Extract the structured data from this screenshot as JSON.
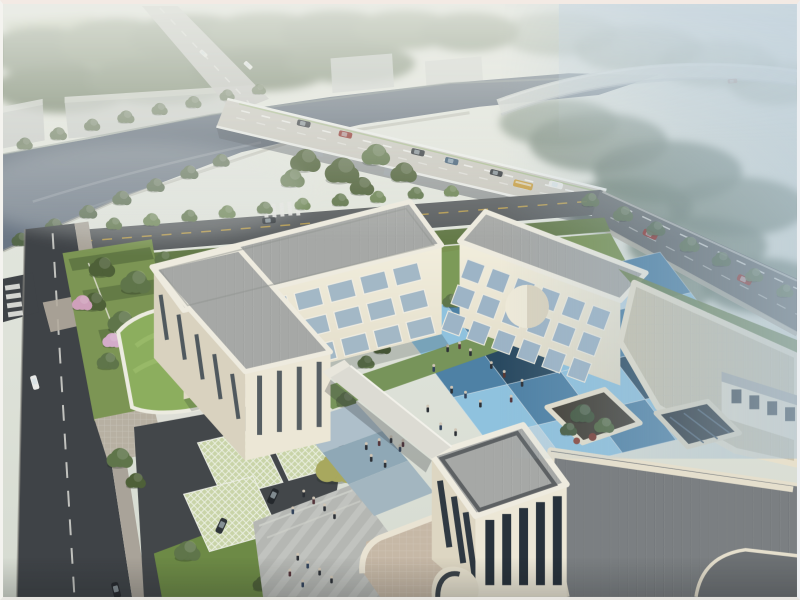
{
  "meta": {
    "title": "Aerial architectural rendering of a courtyard campus beside a river and highway bridge",
    "image_type": "architectural-render",
    "view": "bird's-eye perspective",
    "atmosphere": "hazy daylight, blue mist toward upper right",
    "canvas": {
      "width": 800,
      "height": 600
    }
  },
  "scene": {
    "background": {
      "haze_top": "#e9ebe3",
      "haze_blue": "#a9bfd0",
      "elements": [
        "misty tree canopy",
        "grey warehouse blocks",
        "distant road with small white vehicles",
        "elevated highway ramp curving across upper right"
      ]
    },
    "river": {
      "color": "#5d6a79",
      "description": "tree-lined canal crossing the upper left diagonally"
    },
    "bridge": {
      "deck_color": "#cbc9c0",
      "description": "multi-lane road bridge crossing the river diagonally",
      "vehicles": [
        "dark sedans",
        "dark red car",
        "blue car",
        "yellow bus",
        "white van"
      ],
      "markings": [
        "white dashed lanes",
        "green edge line",
        "white railings"
      ]
    },
    "roads": {
      "asphalt_dark": "#3f4347",
      "asphalt_mid": "#64686a",
      "features": [
        "left perimeter road with dashed centerline and zebra crosswalk",
        "frontage road with yellow dashes and crosswalk",
        "right road with two red cars",
        "entrance drive with boom barrier"
      ]
    },
    "campus": {
      "stories": 3,
      "wall_color": "#ece7d7",
      "roof_paver_light": "#a6a8a6",
      "roof_paver_tan": "#cbc4ad",
      "roof_paver_dark": "#7b7f82",
      "parapet_color": "#eeebdf",
      "wings": [
        "left L-shaped wing",
        "back wing along road",
        "cylindrical stair drum",
        "front wing with entrance drum and pink podium terrace",
        "large east wing with planted roof terrace and glass skylight"
      ],
      "courtyard": {
        "description": "checkerboard plaza of large square pavers in blues with pedestrians and blossom tree",
        "tile_colors": [
          "#8fc2de",
          "#4e81a5",
          "#2a4a61",
          "#b9d2df"
        ]
      },
      "gatehouse": {
        "green_roof": "#8cae5e",
        "description": "curved lawn-roofed entrance canopy with barrier gate"
      },
      "parking": {
        "surface": "grass-grid permeable pavers",
        "color": "#c9d4a8",
        "parked_cars": 2
      },
      "plaza": {
        "color": "#b5b7b3",
        "description": "striped paved forecourt with pedestrian groups"
      },
      "landscape": {
        "lawn": "#7c9554",
        "tree_greens": [
          "#4e6038",
          "#5f754a",
          "#6d8554"
        ],
        "accents": [
          "pink blossom trees",
          "yellow-green tree"
        ]
      }
    },
    "vehicle_colors": {
      "red": "#8e2f2a",
      "dark": "#2e3338",
      "white": "#e9eae8",
      "bus_yellow": "#c79b3b",
      "blue": "#3d5a74"
    }
  },
  "courtyard_fills": [
    "#8fc2de",
    "#4e81a5",
    "#8fc2de",
    "#b9d2df",
    "#4e81a5",
    "#4e81a5",
    "#2a4a61",
    "#8fc2de",
    "#4e81a5",
    "#8fc2de",
    "#8fc2de",
    "#4e81a5",
    "#8fc2de",
    "#2a4a61",
    "#4e81a5",
    "#b9d2df",
    "#8fc2de",
    "#4e81a5",
    "#8fc2de",
    "#2a4a61"
  ],
  "people": {
    "courtyard_count": 14,
    "plaza_count": 11,
    "garden_count": 3
  }
}
